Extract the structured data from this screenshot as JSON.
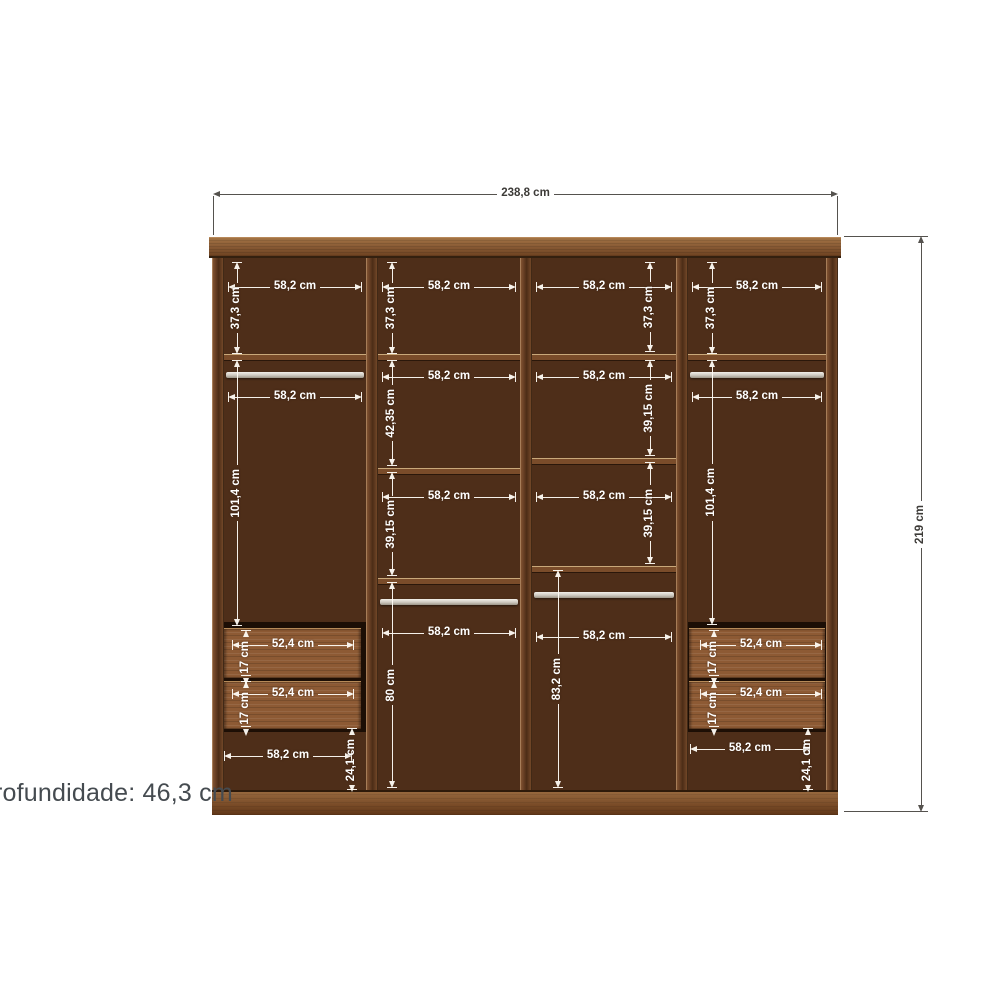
{
  "diagram": {
    "type": "wardrobe-dimension-diagram",
    "depth_note": "rofundidade: 46,3 cm",
    "overall_width_label": "238,8 cm",
    "overall_height_label": "219 cm"
  },
  "colors": {
    "background": "#ffffff",
    "wood_interior": "#4e2e19",
    "wood_frame": "#8a5c36",
    "drawer_front": "#8d5a34",
    "rail_metal": "#cdc8bf",
    "dim_light": "#ffffff",
    "dim_dark": "#3d3b38",
    "note_text": "#454b50"
  },
  "dims": [
    {
      "name": "overall-width",
      "o": "h",
      "x": 213,
      "y": 194,
      "len": 625,
      "label": "238,8 cm",
      "s": "dark",
      "ext": {
        "off": 2,
        "len": 39
      }
    },
    {
      "name": "overall-height",
      "o": "v",
      "x": 921,
      "y": 236,
      "len": 576,
      "label": "219 cm",
      "s": "dark",
      "ext": {
        "off": -77,
        "len": 84
      }
    },
    {
      "name": "c1-top-width",
      "o": "h",
      "x": 228,
      "y": 287,
      "len": 134,
      "label": "58,2 cm",
      "s": "light",
      "ticks": true
    },
    {
      "name": "c2-top-width",
      "o": "h",
      "x": 382,
      "y": 287,
      "len": 134,
      "label": "58,2 cm",
      "s": "light",
      "ticks": true
    },
    {
      "name": "c3-top-width",
      "o": "h",
      "x": 536,
      "y": 287,
      "len": 136,
      "label": "58,2 cm",
      "s": "light",
      "ticks": true
    },
    {
      "name": "c4-top-width",
      "o": "h",
      "x": 692,
      "y": 287,
      "len": 130,
      "label": "58,2 cm",
      "s": "light",
      "ticks": true
    },
    {
      "name": "c1-top-height",
      "o": "v",
      "x": 237,
      "y": 262,
      "len": 92,
      "label": "37,3 cm",
      "s": "light",
      "ticks": true
    },
    {
      "name": "c2-top-height",
      "o": "v",
      "x": 392,
      "y": 262,
      "len": 92,
      "label": "37,3 cm",
      "s": "light",
      "ticks": true
    },
    {
      "name": "c3-top-height",
      "o": "v",
      "x": 650,
      "y": 262,
      "len": 90,
      "label": "37,3 cm",
      "s": "light",
      "ticks": true
    },
    {
      "name": "c4-top-height",
      "o": "v",
      "x": 712,
      "y": 262,
      "len": 92,
      "label": "37,3 cm",
      "s": "light",
      "ticks": true
    },
    {
      "name": "c1-rail-width",
      "o": "h",
      "x": 228,
      "y": 397,
      "len": 134,
      "label": "58,2 cm",
      "s": "light",
      "ticks": true
    },
    {
      "name": "c4-rail-width",
      "o": "h",
      "x": 692,
      "y": 397,
      "len": 130,
      "label": "58,2 cm",
      "s": "light",
      "ticks": true
    },
    {
      "name": "c2-shelf1-width",
      "o": "h",
      "x": 382,
      "y": 377,
      "len": 134,
      "label": "58,2 cm",
      "s": "light",
      "ticks": true
    },
    {
      "name": "c3-shelf1-width",
      "o": "h",
      "x": 536,
      "y": 377,
      "len": 136,
      "label": "58,2 cm",
      "s": "light",
      "ticks": true
    },
    {
      "name": "c1-hang-height",
      "o": "v",
      "x": 237,
      "y": 360,
      "len": 266,
      "label": "101,4 cm",
      "s": "light",
      "ticks": true
    },
    {
      "name": "c4-hang-height",
      "o": "v",
      "x": 712,
      "y": 360,
      "len": 265,
      "label": "101,4 cm",
      "s": "light",
      "ticks": true
    },
    {
      "name": "c2-sec2-height",
      "o": "v",
      "x": 392,
      "y": 360,
      "len": 106,
      "label": "42,35 cm",
      "s": "light",
      "ticks": true
    },
    {
      "name": "c2-shelf2-width",
      "o": "h",
      "x": 382,
      "y": 497,
      "len": 134,
      "label": "58,2 cm",
      "s": "light",
      "ticks": true
    },
    {
      "name": "c2-sec3-height",
      "o": "v",
      "x": 392,
      "y": 472,
      "len": 104,
      "label": "39,15 cm",
      "s": "light",
      "ticks": true
    },
    {
      "name": "c2-bottom-width",
      "o": "h",
      "x": 382,
      "y": 633,
      "len": 134,
      "label": "58,2 cm",
      "s": "light",
      "ticks": true
    },
    {
      "name": "c2-bottom-height",
      "o": "v",
      "x": 392,
      "y": 582,
      "len": 206,
      "label": "80 cm",
      "s": "light",
      "ticks": true
    },
    {
      "name": "c3-sec2-height",
      "o": "v",
      "x": 650,
      "y": 360,
      "len": 96,
      "label": "39,15 cm",
      "s": "light",
      "ticks": true
    },
    {
      "name": "c3-shelf2-width",
      "o": "h",
      "x": 536,
      "y": 497,
      "len": 136,
      "label": "58,2 cm",
      "s": "light",
      "ticks": true
    },
    {
      "name": "c3-sec3-height",
      "o": "v",
      "x": 650,
      "y": 462,
      "len": 102,
      "label": "39,15 cm",
      "s": "light",
      "ticks": true
    },
    {
      "name": "c3-bottom-width",
      "o": "h",
      "x": 536,
      "y": 637,
      "len": 136,
      "label": "58,2 cm",
      "s": "light",
      "ticks": true
    },
    {
      "name": "c3-bottom-height",
      "o": "v",
      "x": 558,
      "y": 570,
      "len": 218,
      "label": "83,2 cm",
      "s": "light",
      "ticks": true
    },
    {
      "name": "c1-drawer1-width",
      "o": "h",
      "x": 232,
      "y": 645,
      "len": 122,
      "label": "52,4 cm",
      "s": "light",
      "ticks": true
    },
    {
      "name": "c1-drawer1-height",
      "o": "v",
      "x": 246,
      "y": 630,
      "len": 46,
      "label": "17 cm",
      "s": "light",
      "ticks": true
    },
    {
      "name": "c1-drawer2-width",
      "o": "h",
      "x": 232,
      "y": 694,
      "len": 122,
      "label": "52,4 cm",
      "s": "light",
      "ticks": true
    },
    {
      "name": "c1-drawer2-height",
      "o": "v",
      "x": 246,
      "y": 681,
      "len": 46,
      "label": "17 cm",
      "s": "light",
      "ticks": true
    },
    {
      "name": "c4-drawer1-width",
      "o": "h",
      "x": 700,
      "y": 645,
      "len": 122,
      "label": "52,4 cm",
      "s": "light",
      "ticks": true
    },
    {
      "name": "c4-drawer1-height",
      "o": "v",
      "x": 714,
      "y": 630,
      "len": 46,
      "label": "17 cm",
      "s": "light",
      "ticks": true
    },
    {
      "name": "c4-drawer2-width",
      "o": "h",
      "x": 700,
      "y": 694,
      "len": 122,
      "label": "52,4 cm",
      "s": "light",
      "ticks": true
    },
    {
      "name": "c4-drawer2-height",
      "o": "v",
      "x": 714,
      "y": 681,
      "len": 46,
      "label": "17 cm",
      "s": "light",
      "ticks": true
    },
    {
      "name": "c1-base-width",
      "o": "h",
      "x": 224,
      "y": 756,
      "len": 128,
      "label": "58,2 cm",
      "s": "light",
      "ticks": true
    },
    {
      "name": "c1-base-height",
      "o": "v",
      "x": 352,
      "y": 728,
      "len": 62,
      "label": "24,1 cm",
      "s": "light",
      "ticks": true
    },
    {
      "name": "c4-base-width",
      "o": "h",
      "x": 690,
      "y": 749,
      "len": 120,
      "label": "58,2 cm",
      "s": "light",
      "ticks": true
    },
    {
      "name": "c4-base-height",
      "o": "v",
      "x": 808,
      "y": 728,
      "len": 62,
      "label": "24,1 cm",
      "s": "light",
      "ticks": true
    }
  ]
}
